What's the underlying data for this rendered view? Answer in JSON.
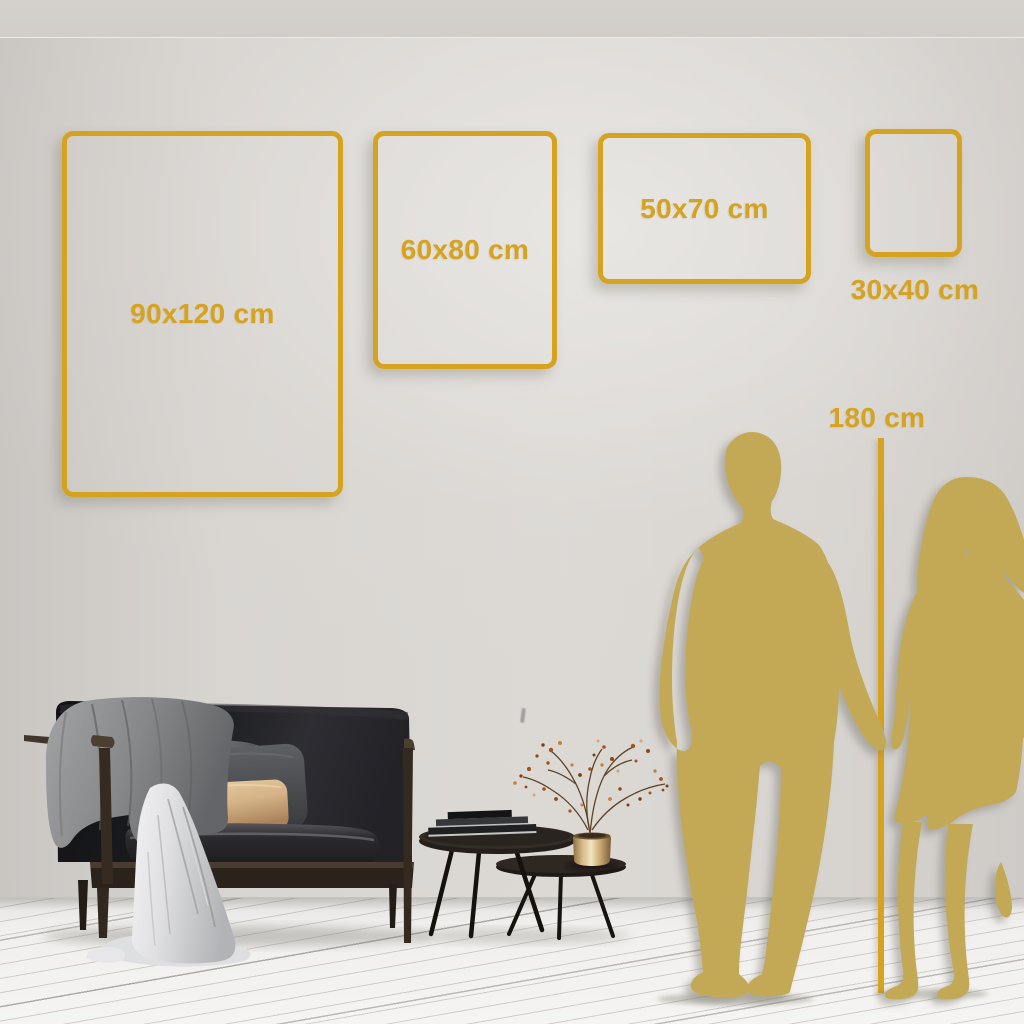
{
  "size_guide": {
    "frames": [
      {
        "name": "frame-90x120",
        "label": "90x120 cm"
      },
      {
        "name": "frame-60x80",
        "label": "60x80 cm"
      },
      {
        "name": "frame-50x70",
        "label": "50x70 cm"
      },
      {
        "name": "frame-30x40",
        "label": "30x40 cm"
      }
    ],
    "height_marker": {
      "label": "180 cm"
    }
  },
  "scene_elements": [
    "couple-silhouette",
    "man-silhouette",
    "woman-silhouette",
    "sofa",
    "gray-blanket",
    "white-throw",
    "back-cushion",
    "dark-pillow",
    "tan-pillow",
    "nesting-coffee-tables",
    "books-stack",
    "gold-vase",
    "dried-branches",
    "wood-plank-floor",
    "wall",
    "ceiling"
  ],
  "colors": {
    "accent_gold": "#D5A31F",
    "silhouette_gold": "#C3A956",
    "wall_light": "#DBD8D4",
    "floor_light": "#F3F2F0"
  }
}
